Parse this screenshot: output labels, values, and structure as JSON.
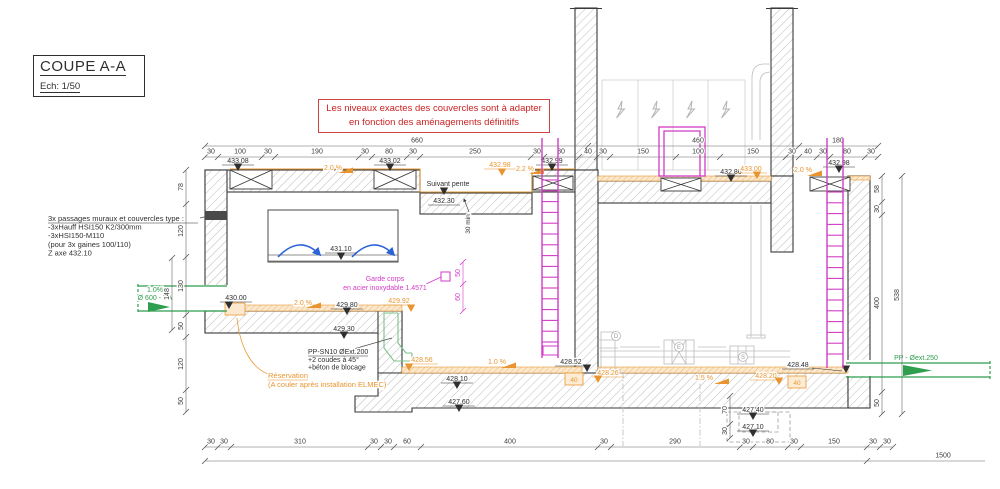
{
  "title_block": {
    "title": "COUPE A-A",
    "scale": "Ech: 1/50"
  },
  "note_box": {
    "line1": "Les niveaux exactes des couvercles sont à adapter",
    "line2": "en fonction des aménagements définitifs"
  },
  "colors": {
    "k": "#2f2f2f",
    "o": "#e8952f",
    "m": "#d23bc7",
    "g": "#2f9e4f",
    "f": "#a8a8a8",
    "dim": "#3c3c3c",
    "red": "#cc2222"
  },
  "notes": [
    {
      "name": "wall-passages-note",
      "x": 48,
      "y": 221,
      "dy": 8.6,
      "s": 7.5,
      "c": "k",
      "ul": 150,
      "lines": [
        "3x passages muraux et couvercles type :",
        "-3xHauff HSI150  K2/300mm",
        "-3xHSI150-M110",
        "(pour 3x gaines 100/110)",
        "Z axe 432.10"
      ]
    },
    {
      "name": "pp-pipe-note",
      "x": 308,
      "y": 354,
      "dy": 7.8,
      "s": 7,
      "c": "k",
      "ul": 60,
      "lines": [
        "PP-SN10 ØExt.200",
        "+2 coudes à 45°",
        "+béton de blocage"
      ]
    },
    {
      "name": "reservation-note",
      "x": 268,
      "y": 378,
      "dy": 9,
      "s": 7.5,
      "c": "o",
      "ul": 40,
      "lines": [
        "Réservation",
        "(A couler après installation ELMEC)"
      ]
    },
    {
      "name": "guardrail-note",
      "x": 385,
      "y": 281,
      "dy": 9,
      "s": 7,
      "c": "m",
      "anchor": "middle",
      "lines": [
        "Garde corps",
        "en acier inoxydable 1.4571"
      ]
    },
    {
      "name": "inlet-pipe-label",
      "x": 155,
      "y": 292,
      "dy": 8,
      "s": 7,
      "c": "g",
      "anchor": "middle",
      "lines": [
        "1.0%",
        "Ø 600 - BA"
      ]
    },
    {
      "name": "outlet-pipe-label",
      "x": 916,
      "y": 360,
      "dy": 8,
      "s": 7,
      "c": "g",
      "anchor": "middle",
      "lines": [
        "PP - Øext.250"
      ]
    },
    {
      "name": "suivant-pente-label",
      "x": 448,
      "y": 186,
      "dy": 8,
      "s": 7,
      "c": "k",
      "anchor": "middle",
      "lines": [
        "Suivant pente"
      ]
    },
    {
      "name": "min-cover-label",
      "x": 470,
      "y": 224,
      "dy": 8,
      "s": 6.5,
      "c": "k",
      "anchor": "middle",
      "rot": -90,
      "lines": [
        "30 min"
      ]
    }
  ],
  "levels": [
    {
      "t": "433.08",
      "x": 238,
      "y": 163,
      "c": "k",
      "tx": 238,
      "ty": 171
    },
    {
      "t": "433.02",
      "x": 390,
      "y": 163,
      "c": "k",
      "tx": 390,
      "ty": 171
    },
    {
      "t": "432.98",
      "x": 500,
      "y": 167,
      "c": "o",
      "tx": 502,
      "ty": 176
    },
    {
      "t": "432.99",
      "x": 552,
      "y": 163,
      "c": "k",
      "tx": 552,
      "ty": 171
    },
    {
      "t": "432.30",
      "x": 444,
      "y": 203,
      "c": "k",
      "tx": 444,
      "ty": 195
    },
    {
      "t": "431.10",
      "x": 341,
      "y": 251,
      "c": "k",
      "tx": 341,
      "ty": 260
    },
    {
      "t": "430.00",
      "x": 236,
      "y": 300,
      "c": "k",
      "tx": 229,
      "ty": 309
    },
    {
      "t": "429.80",
      "x": 347,
      "y": 307,
      "c": "k",
      "tx": 347,
      "ty": 315
    },
    {
      "t": "429.92",
      "x": 399,
      "y": 303,
      "c": "o",
      "tx": 411,
      "ty": 312
    },
    {
      "t": "429.30",
      "x": 344,
      "y": 331,
      "c": "k",
      "tx": 344,
      "ty": 339
    },
    {
      "t": "428.56",
      "x": 422,
      "y": 362,
      "c": "o",
      "tx": 409,
      "ty": 371
    },
    {
      "t": "428.52",
      "x": 571,
      "y": 364,
      "c": "k",
      "tx": 587,
      "ty": 372
    },
    {
      "t": "428.10",
      "x": 457,
      "y": 381,
      "c": "k",
      "tx": 457,
      "ty": 389
    },
    {
      "t": "427.60",
      "x": 459,
      "y": 404,
      "c": "k",
      "tx": 459,
      "ty": 412
    },
    {
      "t": "428.26",
      "x": 608,
      "y": 375,
      "c": "o",
      "tx": 598,
      "ty": 383
    },
    {
      "t": "428.20",
      "x": 766,
      "y": 378,
      "c": "o",
      "tx": 779,
      "ty": 385
    },
    {
      "t": "428.48",
      "x": 798,
      "y": 367,
      "c": "k",
      "tx": 846,
      "ty": 373,
      "ld": [
        812,
        368,
        842,
        371
      ]
    },
    {
      "t": "427.40",
      "x": 753,
      "y": 412,
      "c": "k",
      "tx": 753,
      "ty": 420
    },
    {
      "t": "427.10",
      "x": 753,
      "y": 429,
      "c": "k",
      "tx": 753,
      "ty": 437
    },
    {
      "t": "432.86",
      "x": 731,
      "y": 174,
      "c": "k",
      "tx": 731,
      "ty": 182
    },
    {
      "t": "433.00",
      "x": 751,
      "y": 171,
      "c": "o",
      "tx": 757,
      "ty": 179
    },
    {
      "t": "432.98",
      "x": 839,
      "y": 165,
      "c": "k",
      "tx": 839,
      "ty": 173
    }
  ],
  "slopes": [
    {
      "t": "2.0 %",
      "x": 333,
      "y": 170,
      "fx": 353,
      "fy": 173
    },
    {
      "t": "2.2 %",
      "x": 525,
      "y": 171,
      "fx": 544,
      "fy": 174
    },
    {
      "t": "2.0 %",
      "x": 303,
      "y": 305,
      "fx": 321,
      "fy": 308
    },
    {
      "t": "1.0 %",
      "x": 497,
      "y": 364,
      "fx": 516,
      "fy": 368
    },
    {
      "t": "1.5 %",
      "x": 704,
      "y": 380,
      "fx": 729,
      "fy": 384
    },
    {
      "t": "2.0 %",
      "x": 803,
      "y": 172,
      "fx": 822,
      "fy": 176
    }
  ],
  "boxes40": [
    {
      "t": "40",
      "bx": 565,
      "by": 373
    },
    {
      "t": "40",
      "bx": 788,
      "by": 376
    }
  ],
  "equip_tags": [
    {
      "t": "D",
      "x": 616,
      "y": 338
    },
    {
      "t": "E",
      "x": 679,
      "y": 349
    },
    {
      "t": "S",
      "x": 743,
      "y": 359
    }
  ],
  "dim_rows": [
    {
      "y": 157,
      "x1": 205,
      "x2": 878,
      "ticks": [
        205,
        218,
        262,
        275,
        359,
        372,
        407,
        420,
        531,
        544,
        579,
        597,
        610,
        676,
        720,
        786,
        799,
        817,
        830,
        865,
        878
      ],
      "labels": [
        [
          "30",
          211
        ],
        [
          "100",
          240
        ],
        [
          "30",
          268
        ],
        [
          "190",
          317
        ],
        [
          "30",
          365
        ],
        [
          "80",
          389
        ],
        [
          "30",
          413
        ],
        [
          "250",
          475
        ],
        [
          "30",
          537
        ],
        [
          "80",
          561
        ],
        [
          "40",
          588
        ],
        [
          "30",
          603
        ],
        [
          "150",
          643
        ],
        [
          "100",
          698
        ],
        [
          "150",
          753
        ],
        [
          "30",
          792
        ],
        [
          "40",
          808
        ],
        [
          "30",
          823
        ],
        [
          "80",
          847
        ],
        [
          "30",
          871
        ]
      ]
    },
    {
      "y": 146,
      "x1": 205,
      "x2": 878,
      "ticks": [
        205,
        588,
        799,
        878
      ],
      "labels": [
        [
          "660",
          417
        ],
        [
          "460",
          698
        ],
        [
          "180",
          838
        ]
      ]
    },
    {
      "y": 447,
      "x1": 205,
      "x2": 893,
      "ticks": [
        205,
        218,
        231,
        368,
        381,
        394,
        421,
        598,
        611,
        740,
        753,
        788,
        801,
        867,
        880,
        893
      ],
      "labels": [
        [
          "30",
          211
        ],
        [
          "30",
          224
        ],
        [
          "310",
          300
        ],
        [
          "30",
          374
        ],
        [
          "30",
          388
        ],
        [
          "60",
          407
        ],
        [
          "400",
          510
        ],
        [
          "30",
          604
        ],
        [
          "290",
          675
        ],
        [
          "30",
          746
        ],
        [
          "80",
          770
        ],
        [
          "30",
          794
        ],
        [
          "150",
          834
        ],
        [
          "30",
          873
        ],
        [
          "30",
          887
        ]
      ]
    },
    {
      "y": 461,
      "x1": 205,
      "x2": 985,
      "ticks": [
        205,
        867
      ],
      "labels": [
        [
          "1500",
          943
        ]
      ]
    }
  ],
  "vdims": [
    {
      "x": 186,
      "y1": 170,
      "y2": 412,
      "ticks": [
        170,
        204,
        257,
        315,
        337,
        390,
        412
      ],
      "labels": [
        [
          "78",
          187
        ],
        [
          "120",
          231
        ],
        [
          "130",
          286
        ],
        [
          "50",
          326
        ],
        [
          "120",
          364
        ],
        [
          "50",
          401
        ]
      ],
      "c": "dim"
    },
    {
      "x": 172,
      "y1": 258,
      "y2": 330,
      "ticks": [
        258,
        330
      ],
      "labels": [
        [
          "148",
          294
        ]
      ],
      "c": "dim"
    },
    {
      "x": 882,
      "y1": 176,
      "y2": 414,
      "ticks": [
        176,
        202,
        215,
        392,
        414
      ],
      "labels": [
        [
          "58",
          189
        ],
        [
          "30",
          209
        ],
        [
          "400",
          303
        ],
        [
          "50",
          403
        ]
      ],
      "c": "dim"
    },
    {
      "x": 902,
      "y1": 176,
      "y2": 414,
      "ticks": [
        176,
        414
      ],
      "labels": [
        [
          "538",
          295
        ]
      ],
      "c": "dim"
    },
    {
      "x": 730,
      "y1": 396,
      "y2": 438,
      "ticks": [
        396,
        424,
        438
      ],
      "labels": [
        [
          "70",
          410
        ],
        [
          "30",
          431
        ]
      ],
      "c": "dim"
    },
    {
      "x": 463,
      "y1": 262,
      "y2": 311,
      "ticks": [
        262,
        284,
        311
      ],
      "labels": [
        [
          "50",
          273
        ],
        [
          "60",
          297
        ]
      ],
      "c": "m"
    }
  ],
  "ladders": [
    {
      "x1": 542,
      "x2": 558,
      "y1": 138,
      "y2": 358,
      "r1": 180,
      "r2": 352,
      "step": 10.8,
      "box": [
        543,
        346,
        15,
        9
      ]
    },
    {
      "x1": 827,
      "x2": 843,
      "y1": 138,
      "y2": 368,
      "r1": 192,
      "r2": 364,
      "step": 10.8
    }
  ]
}
